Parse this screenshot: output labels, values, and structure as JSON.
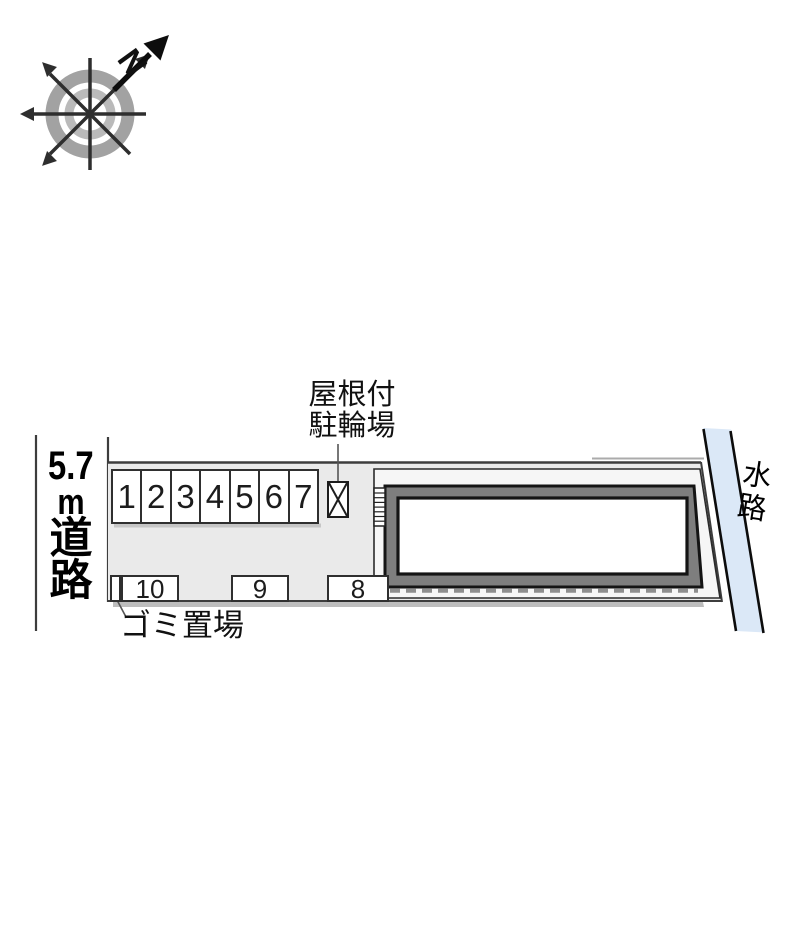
{
  "compass": {
    "north_label": "N"
  },
  "road": {
    "width_label_parts": [
      "5.7",
      "m",
      "道",
      "路"
    ]
  },
  "waterway": {
    "label": "水路"
  },
  "bicycle_parking": {
    "label_line1": "屋根付",
    "label_line2": "駐輪場"
  },
  "garbage": {
    "label": "ゴミ置場"
  },
  "parking": {
    "top_row_stalls": [
      "1",
      "2",
      "3",
      "4",
      "5",
      "6",
      "7"
    ],
    "bottom_row_stalls": [
      "10",
      "9",
      "8"
    ]
  },
  "colors": {
    "site_fill": "#eaeaea",
    "footprint_fill": "#f6f6f6",
    "building_wall": "#7e7e7e",
    "waterway_fill": "#dbe8f7",
    "shadow": "#bdbdbd",
    "boundary_line": "#3d3d3d"
  }
}
